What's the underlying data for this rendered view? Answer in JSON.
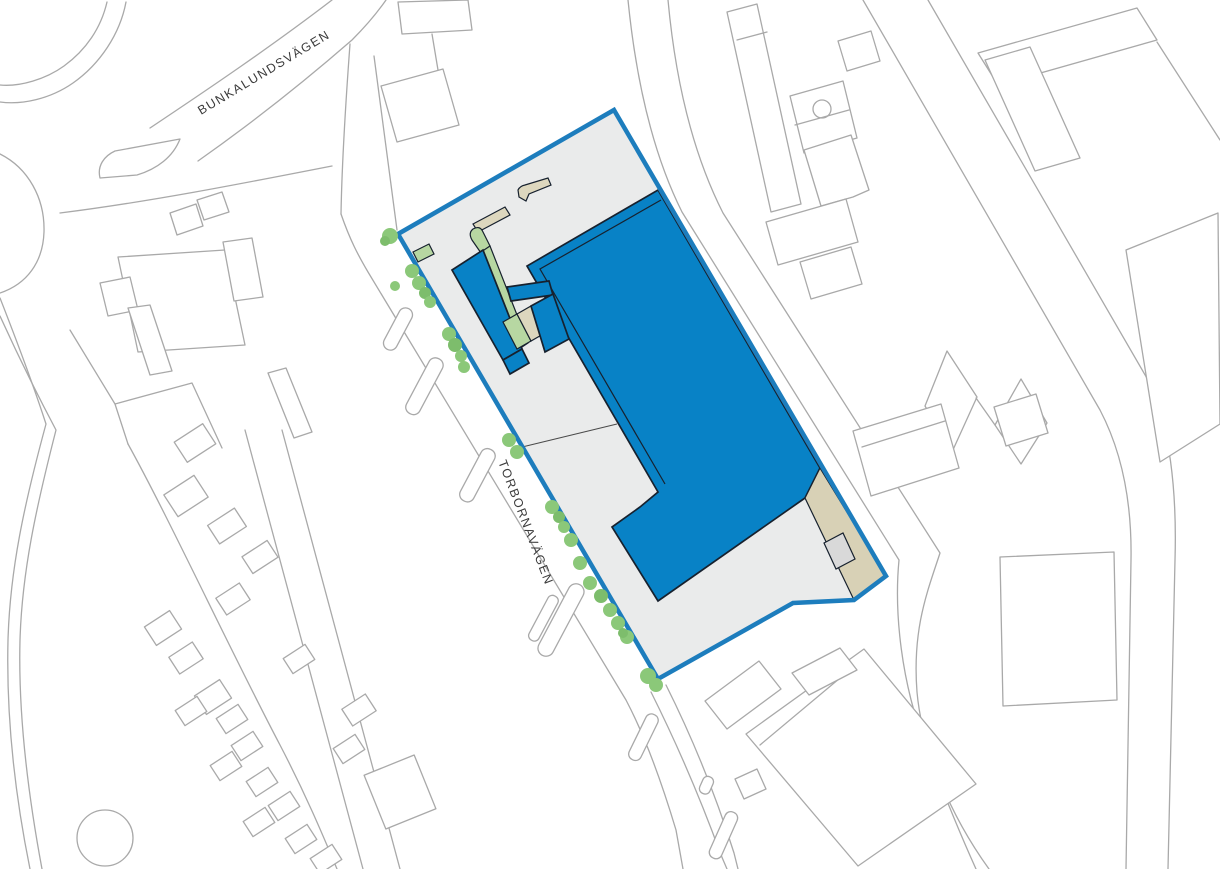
{
  "map": {
    "type": "architectural-site-plan",
    "streets": {
      "north": {
        "name": "BUNKALUNDSVÄGEN"
      },
      "west": {
        "name": "TORBORNAVÄGEN"
      }
    },
    "site": {
      "boundary_color": "#1d7dbd",
      "area_fill": "#eaebeb",
      "building_fill": "#0882c6",
      "building_outline": "#17212e",
      "landscape_green": "#b7d7a2",
      "tree_green": "#8bc879",
      "canopy_beige": "#ddd7be",
      "corner_beige": "#d8d1b6",
      "context_line_gray": "#a9a9a9",
      "tree_count": 25
    }
  }
}
